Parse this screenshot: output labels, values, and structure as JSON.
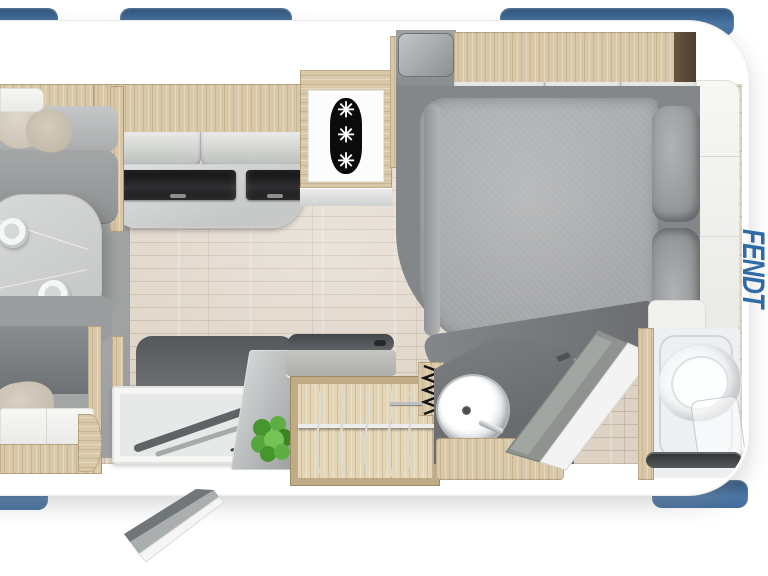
{
  "brand": {
    "logo_text": "FENDT",
    "logo_color": "#2F6BA6"
  },
  "icons": {
    "freezer_rating": {
      "name": "freezer-rating-icon",
      "glyphs": [
        "✳",
        "✳",
        "✳"
      ]
    }
  },
  "colors": {
    "window_blue": "#44719F",
    "body_white": "#FFFFFF",
    "cabinet_wood": "#D8C8A8",
    "floor_wood": "#DDD2C4",
    "lounge_carpet": "#A9ABAB",
    "upholstery_gray": "#97999B",
    "bed_gray": "#A8AAAC",
    "counter_glass_black": "#1B1B1B",
    "bath_counter_gray": "#6D7072",
    "plant_green": "#55A63C"
  }
}
